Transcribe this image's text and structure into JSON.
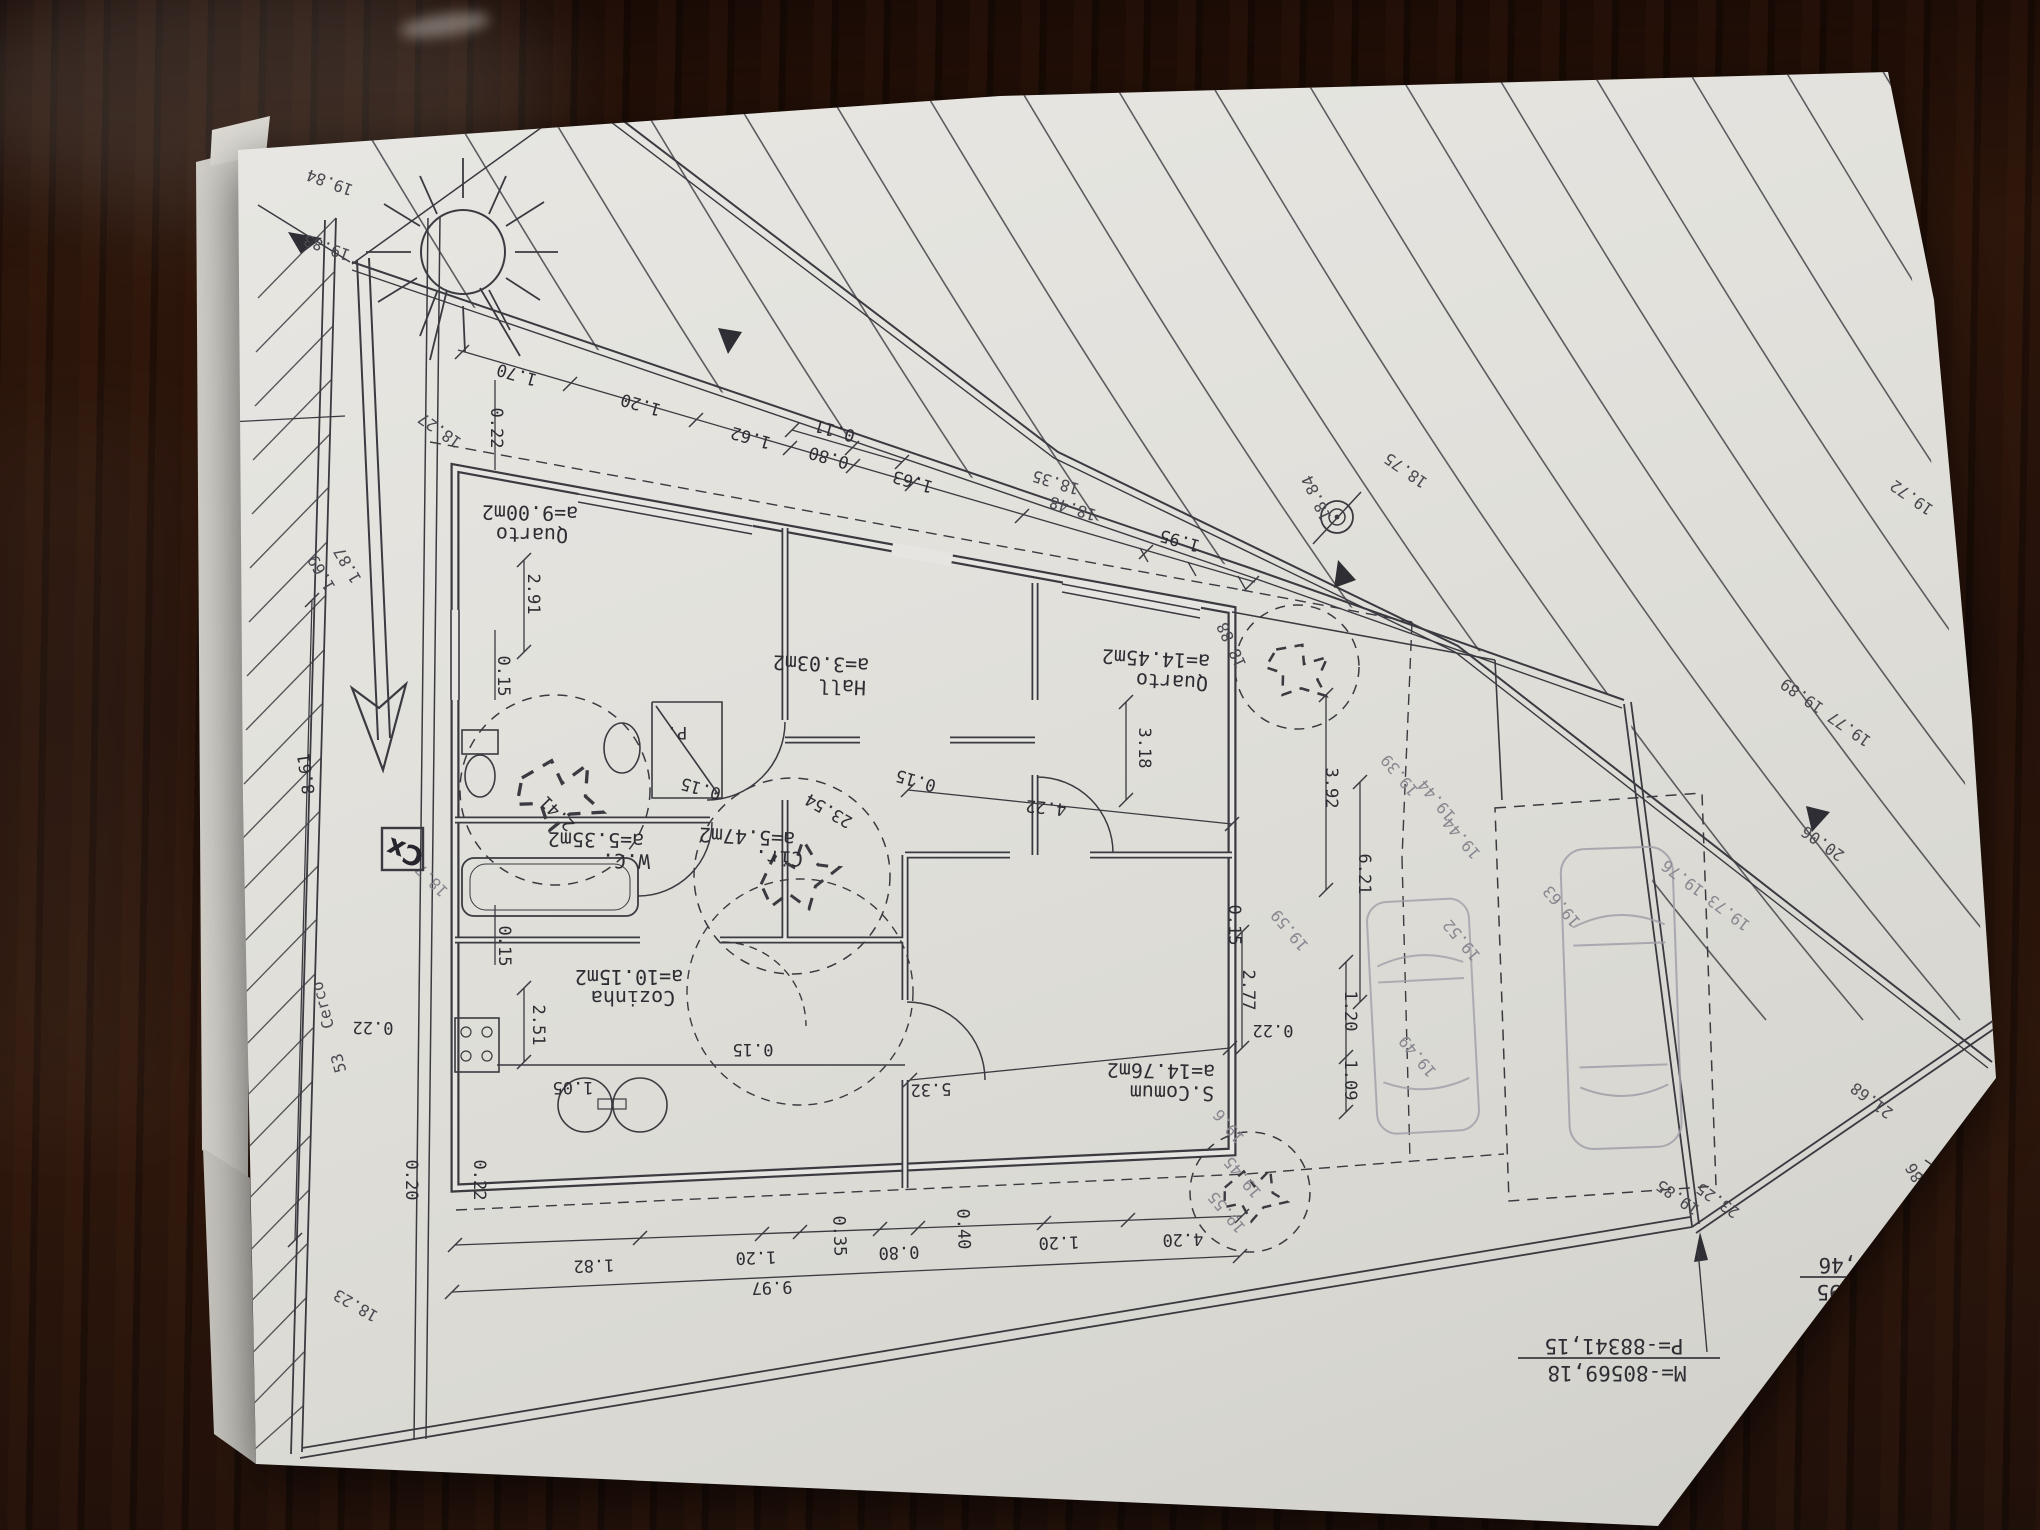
{
  "scene": {
    "description": "Architectural site and floor plan drawing, photographed upside-down on a dark wooden table",
    "colors": {
      "table_wood": "#2a150c",
      "paper": "#e3e2dd",
      "ink": "#3b3a40",
      "pencil": "#a29ea8"
    }
  },
  "rooms": [
    {
      "name": "Quarto",
      "area": "a=9.00m2"
    },
    {
      "name": "Hall",
      "area": "a=3.03m2"
    },
    {
      "name": "Quarto",
      "area": "a=14.45m2"
    },
    {
      "name": "W.C.",
      "area": "a=5.35m2"
    },
    {
      "name": "Cir.",
      "area": "a=5.47m2"
    },
    {
      "name": "Cozinha",
      "area": "a=10.15m2"
    },
    {
      "name": "S.Comum",
      "area": "a=14.76m2"
    }
  ],
  "dims_top": [
    "0.22",
    "1.70",
    "1.20",
    "1.62",
    "0.11",
    "0.80",
    "1.63",
    "1.95"
  ],
  "dims_left": [
    "2.91",
    "0.15",
    "0.15",
    "2.51",
    "0.22",
    "0.20",
    "0.22",
    "8.61"
  ],
  "dims_bottom": [
    "1.82",
    "1.20",
    "0.35",
    "0.80",
    "0.40",
    "1.20",
    "4.20",
    "9.97"
  ],
  "dims_inner": [
    "0.15",
    "0.15",
    "4.22",
    "3.18",
    "0.15",
    "1.05",
    "0.15",
    "2.77",
    "0.22",
    "5.32",
    "3.92",
    "6.21",
    "1.20",
    "1.09",
    "2.41",
    "23.54"
  ],
  "elevations": [
    "19.84",
    "19.83",
    "18.27",
    "18.35",
    "18.48",
    "18.84",
    "18.75",
    "18.88",
    "1.87",
    "1.69",
    "18.7",
    "18.23",
    "19.44",
    "19.44",
    "19.39",
    "19.59",
    "19.52",
    "19.49",
    "19.63",
    "19.73 19.76",
    "19.45",
    "19.55",
    "19.6",
    "19.72",
    "19.77 19.89",
    "20.06",
    "21.68",
    "23.25",
    "19.85",
    "21.86",
    "1.98"
  ],
  "misc": {
    "closet": "P.",
    "fence": "Cerco",
    "fence2": "53",
    "handwritten": "Cx"
  },
  "coord_boxes": [
    {
      "m": "M=-80573,95",
      "p": "P=-88339,46"
    },
    {
      "m": "M=-80569,18",
      "p": "P=-88341,15"
    }
  ]
}
